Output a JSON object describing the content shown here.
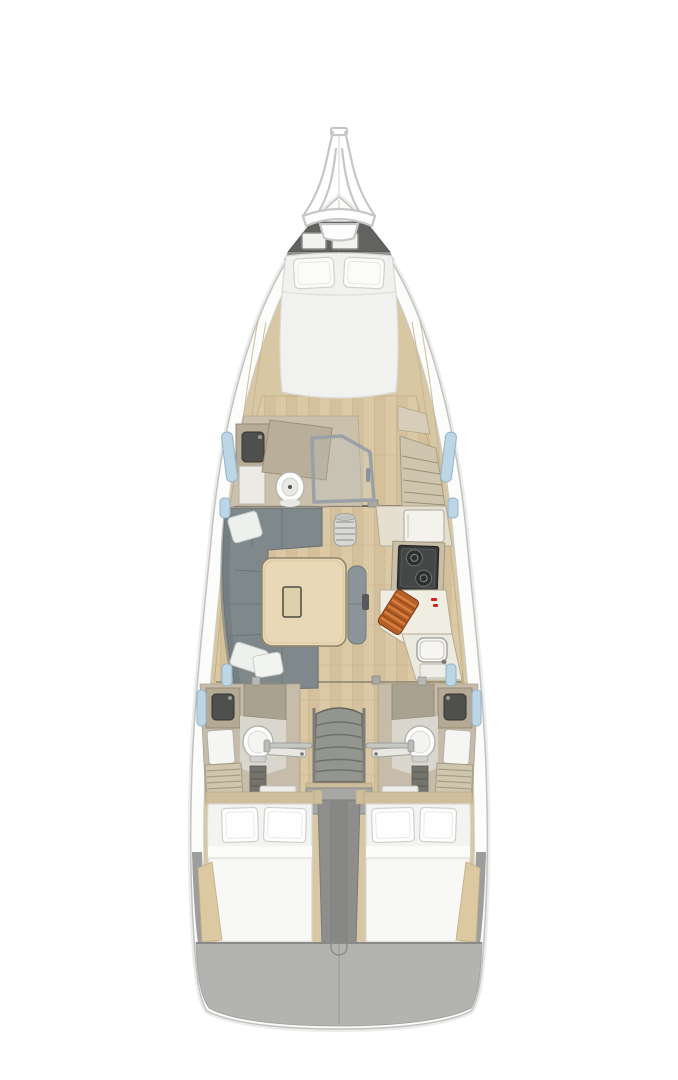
{
  "page": {
    "background": "#ffffff",
    "kind": "yacht-interior-floor-plan-top-view"
  },
  "colors": {
    "deck_white": "#fcfcfb",
    "hull_outline": "#c2c2c0",
    "side_trim_wood": "#d8c7a3",
    "anchor_locker": "#626361",
    "locker_band": "#90918e",
    "mattress": "#f1f1ef",
    "pillow": "#fdfdfc",
    "sofa": "#7f898c",
    "table_wood": "#e9d8b5",
    "counter": "#efece2",
    "cabinet_beige": "#c8bead",
    "stove": "#3a3c3c",
    "cutting_board": "#b55f28",
    "accent_red": "#cc2222",
    "sink_dark": "#4f4f4d",
    "fixture_white": "#f6f6f4",
    "stairs": "#93958f",
    "engine_box": "#8e8e8c",
    "transom": "#b3b3b1",
    "window_glass": "#bcd6e6",
    "grating": "#cfc6ae"
  },
  "areas": {
    "bow": [
      "bow-pulpit",
      "anchor-locker",
      "deck-hatch",
      "deck-hatch"
    ],
    "forward_cabin": [
      "v-berth-double-bed",
      "pillow",
      "pillow"
    ],
    "forward_head": [
      "sink",
      "vanity",
      "toilet",
      "shower-door"
    ],
    "forward_starboard": [
      "shelved-wardrobe",
      "cabinet"
    ],
    "salon": [
      "u-shaped-sofa",
      "folding-table",
      "side-bench",
      "mast-post",
      "pillow",
      "pillow",
      "pillow"
    ],
    "galley": [
      "refrigerator-counter",
      "two-burner-stove",
      "cutting-board",
      "sink",
      "cabinet-door"
    ],
    "companionway": [
      "stairs",
      "handrail",
      "handrail",
      "engine-compartment"
    ],
    "port_aft_head": [
      "sink",
      "vanity",
      "toilet",
      "shower-grating",
      "door"
    ],
    "starboard_aft_head": [
      "sink",
      "vanity",
      "toilet",
      "shower-grating",
      "door"
    ],
    "port_aft_cabin": [
      "double-bed",
      "pillow",
      "pillow"
    ],
    "starboard_aft_cabin": [
      "double-bed",
      "pillow",
      "pillow"
    ],
    "stern": [
      "transom-deck",
      "deck-fitting-ring"
    ]
  }
}
